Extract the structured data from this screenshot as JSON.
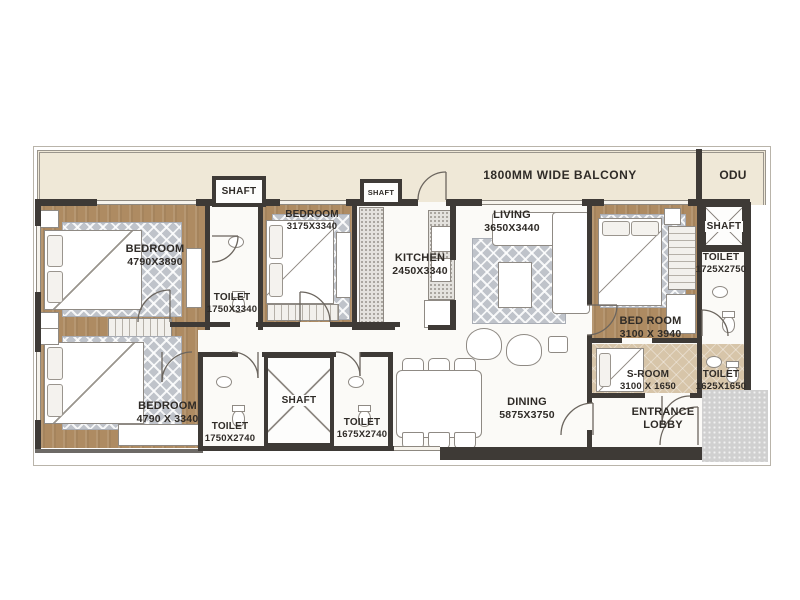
{
  "balcony": {
    "label": "1800MM WIDE BALCONY"
  },
  "odu": {
    "label": "ODU"
  },
  "labels": {
    "shaft": "SHAFT"
  },
  "rooms": {
    "bedroom1": {
      "name": "BEDROOM",
      "dims": "4790X3890"
    },
    "toilet1": {
      "name": "TOILET",
      "dims": "1750X3340"
    },
    "bedroom2": {
      "name": "BEDROOM",
      "dims": "3175X3340"
    },
    "kitchen": {
      "name": "KITCHEN",
      "dims": "2450X3340"
    },
    "living": {
      "name": "LIVING",
      "dims": "3650X3440"
    },
    "bedroom3": {
      "name": "BED ROOM",
      "dims": "3100 X 3940"
    },
    "toilet2": {
      "name": "TOILET",
      "dims": "1725X2750"
    },
    "bedroom4": {
      "name": "BEDROOM",
      "dims": "4790 X 3340"
    },
    "toilet3": {
      "name": "TOILET",
      "dims": "1750X2740"
    },
    "toilet4": {
      "name": "TOILET",
      "dims": "1675X2740"
    },
    "dining": {
      "name": "DINING",
      "dims": "5875X3750"
    },
    "sroom": {
      "name": "S-ROOM",
      "dims": "3100 X 1650"
    },
    "toilet5": {
      "name": "TOILET",
      "dims": "1625X1650"
    },
    "entrance": {
      "line1": "ENTRANCE",
      "line2": "LOBBY"
    }
  },
  "colors": {
    "wall": "#3e3a36",
    "wood_floor": "#ae8b62",
    "balcony_floor": "#efe8d7",
    "tile_floor": "#d7c5a9",
    "rug": "#bfc3ca",
    "core_block": "#d0d0d0"
  }
}
